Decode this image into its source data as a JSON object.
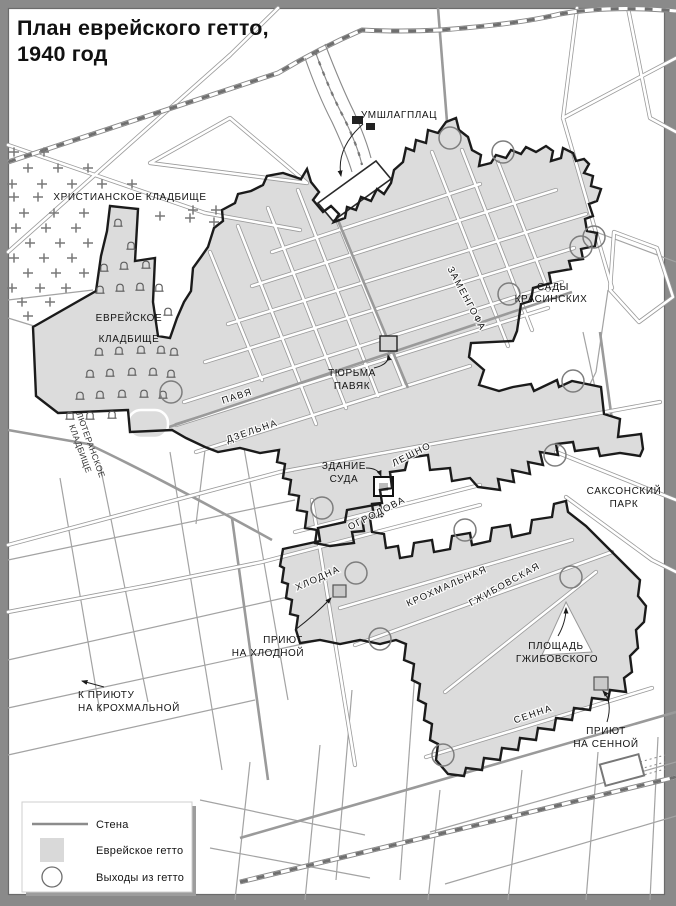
{
  "title": {
    "line1": "План еврейского гетто,",
    "line2": "1940 год"
  },
  "labels": {
    "umschlagplatz": "УМШЛАГПЛАЦ",
    "christian_cemetery": "ХРИСТИАНСКОЕ КЛАДБИЩЕ",
    "jewish_cemetery_l1": "ЕВРЕЙСКОЕ",
    "jewish_cemetery_l2": "КЛАДБИЩЕ",
    "lutheran_cemetery_l1": "ЛЮТЕРАНСКОЕ",
    "lutheran_cemetery_l2": "КЛАДБИЩЕ",
    "krasinski_l1": "САДЫ",
    "krasinski_l2": "КРАСИНСКИХ",
    "pawiak_l1": "ТЮРЬМА",
    "pawiak_l2": "ПАВЯК",
    "court_l1": "ЗДАНИЕ",
    "court_l2": "СУДА",
    "saxon_l1": "САКСОНСКИЙ",
    "saxon_l2": "ПАРК",
    "grzybowski_sq_l1": "ПЛОЩАДЬ",
    "grzybowski_sq_l2": "ГЖИБОВСКОГО",
    "orphanage_chlodna_l1": "ПРИЮТ",
    "orphanage_chlodna_l2": "НА ХЛОДНОЙ",
    "orphanage_krochmalna_l1": "К ПРИЮТУ",
    "orphanage_krochmalna_l2": "НА КРОХМАЛЬНОЙ",
    "orphanage_sienna_l1": "ПРИЮТ",
    "orphanage_sienna_l2": "НА СЕННОЙ"
  },
  "streets": {
    "zamenhofa": "ЗАМЕНГОФА",
    "pawia": "ПАВЯ",
    "dzielna": "ДЗЕЛЬНА",
    "leszno": "ЛЕШНО",
    "ogrodowa": "ОГРОДОВА",
    "chlodna": "ХЛОДНА",
    "krochmalna": "КРОХМАЛЬНАЯ",
    "grzybowska": "ГЖИБОВСКАЯ",
    "sienna": "СЕННА"
  },
  "legend": {
    "wall": "Стена",
    "ghetto": "Еврейское гетто",
    "exits": "Выходы из гетто"
  },
  "colors": {
    "frame": "#8a8a8a",
    "map_bg": "#ffffff",
    "ghetto_fill": "#dcdcdc",
    "wall_line": "#1b1b1b",
    "road": "#9a9a9a",
    "legend_wall_sample": "#8c8c8c",
    "text": "#141414"
  },
  "icons": {
    "christian_grave": "cross-symbol",
    "jewish_grave": "matzevah-arch-symbol",
    "ghetto_exit": "circle-outline"
  }
}
